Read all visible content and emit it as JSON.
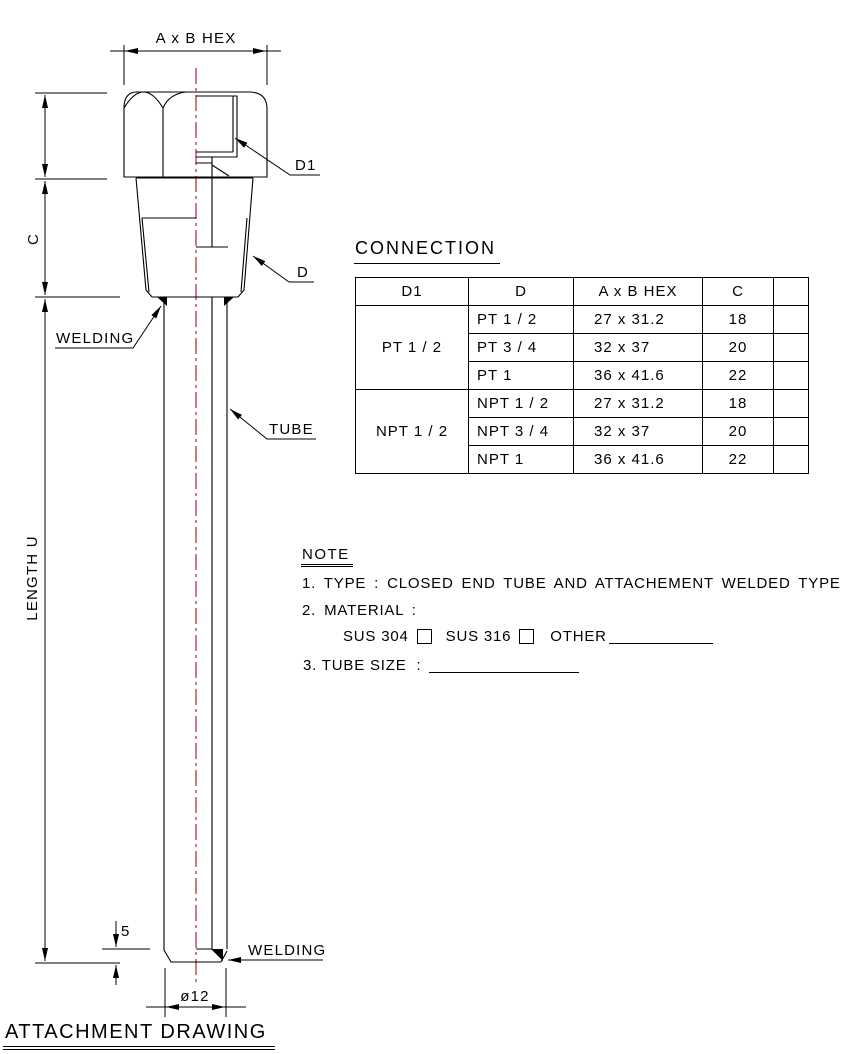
{
  "colors": {
    "ink": "#000000",
    "centerline": "#b5232f",
    "background": "#ffffff"
  },
  "drawing": {
    "dim_hex_width": "A x B HEX",
    "label_bore": "D1",
    "label_thread": "D",
    "dim_thread_length": "C",
    "label_welding_upper": "WELDING",
    "label_tube": "TUBE",
    "dim_tube_length": "LENGTH U",
    "dim_tip_thickness": "5",
    "label_welding_lower": "WELDING",
    "dim_tube_diameter": "ø12"
  },
  "connection": {
    "title": "CONNECTION",
    "headers": [
      "D1",
      "D",
      "A x B HEX",
      "C",
      ""
    ],
    "groups": [
      {
        "d1": "PT 1 / 2",
        "rows": [
          {
            "d": "PT 1 / 2",
            "hex": "27 x 31.2",
            "c": "18",
            "extra": ""
          },
          {
            "d": "PT 3 / 4",
            "hex": "32 x 37",
            "c": "20",
            "extra": ""
          },
          {
            "d": "PT 1",
            "hex": "36 x 41.6",
            "c": "22",
            "extra": ""
          }
        ]
      },
      {
        "d1": "NPT 1 / 2",
        "rows": [
          {
            "d": "NPT 1 / 2",
            "hex": "27 x 31.2",
            "c": "18",
            "extra": ""
          },
          {
            "d": "NPT 3 / 4",
            "hex": "32 x 37",
            "c": "20",
            "extra": ""
          },
          {
            "d": "NPT 1",
            "hex": "36 x 41.6",
            "c": "22",
            "extra": ""
          }
        ]
      }
    ]
  },
  "note": {
    "title": "NOTE",
    "item_type": "1. TYPE : CLOSED END TUBE AND ATTACHEMENT WELDED TYPE",
    "item_material": "2. MATERIAL :",
    "material_option_1": "SUS 304",
    "material_option_2": "SUS 316",
    "material_other": "OTHER",
    "item_tube_size": "3. TUBE SIZE  :"
  },
  "footer": {
    "title": "ATTACHMENT DRAWING"
  }
}
